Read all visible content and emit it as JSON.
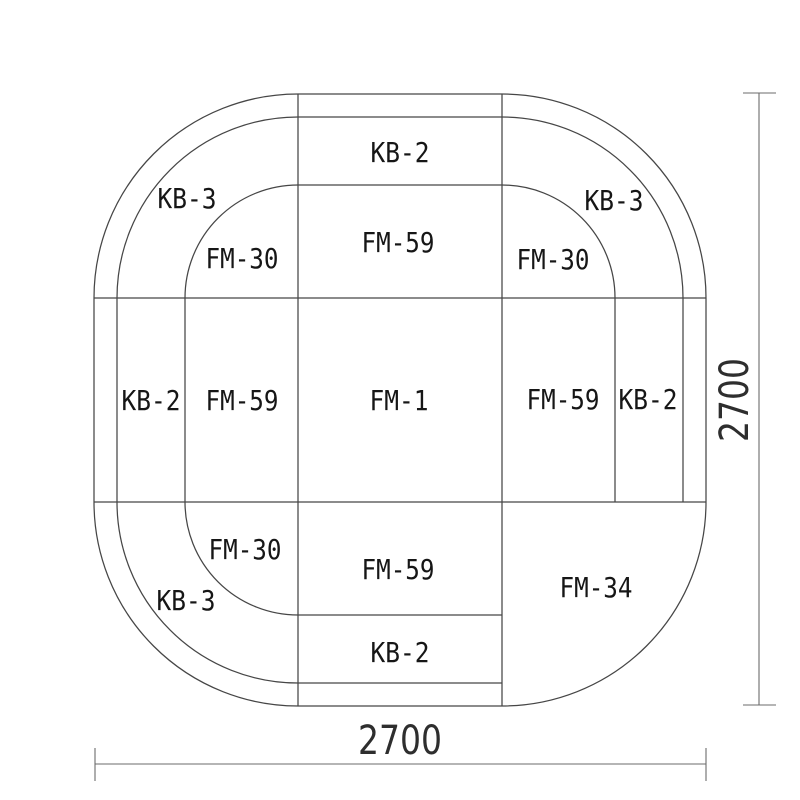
{
  "diagram": {
    "kind": "sofa-layout-plan",
    "style": {
      "background": "#ffffff",
      "plan_line_color": "#464646",
      "dimension_line_color": "#6b6b6b",
      "label_color": "#161616"
    },
    "labels": {
      "top_kb": "KB-2",
      "top_fm": "FM-59",
      "left_kb": "KB-2",
      "left_fm": "FM-59",
      "right_fm": "FM-59",
      "right_kb": "KB-2",
      "bottom_fm": "FM-59",
      "bottom_kb": "KB-2",
      "center": "FM-1",
      "corner_tl_kb": "KB-3",
      "corner_tl_fm": "FM-30",
      "corner_tr_kb": "KB-3",
      "corner_tr_fm": "FM-30",
      "corner_bl_kb": "KB-3",
      "corner_bl_fm": "FM-30",
      "corner_br_fm": "FM-34"
    },
    "dimensions": {
      "width": "2700",
      "height": "2700"
    }
  }
}
